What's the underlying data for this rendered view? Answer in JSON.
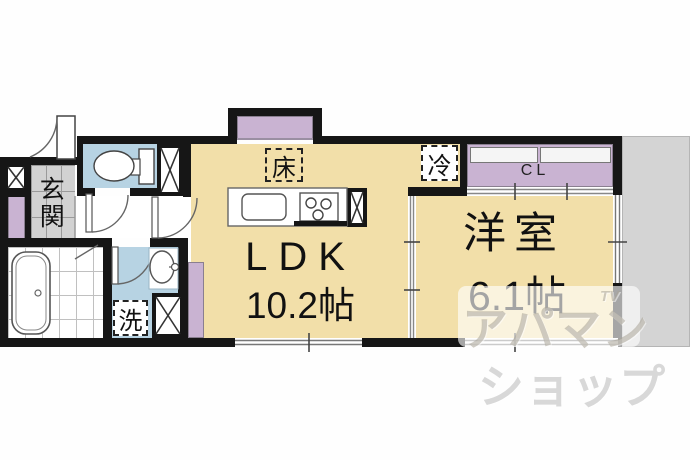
{
  "floorplan": {
    "rooms": {
      "ldk": {
        "name": "LDK",
        "size": "10.2帖"
      },
      "western_room": {
        "name": "洋室",
        "size": "6.1帖"
      },
      "entrance": {
        "label": "玄関"
      },
      "closet": {
        "label": "CL"
      },
      "alcove": {
        "label": "床"
      },
      "refrigerator": {
        "label": "冷"
      },
      "washer": {
        "label": "洗"
      }
    },
    "colors": {
      "room_floor": "#f2dfa9",
      "wet_area": "#b7d3e3",
      "storage_accent": "#c9b3d2",
      "entrance_tile": "#d2d2d2",
      "outside_area": "#d4d4d4",
      "wall": "#161616"
    },
    "watermark": {
      "line1": "アパマン",
      "line2": "ショップ",
      "logo": "TV"
    }
  }
}
